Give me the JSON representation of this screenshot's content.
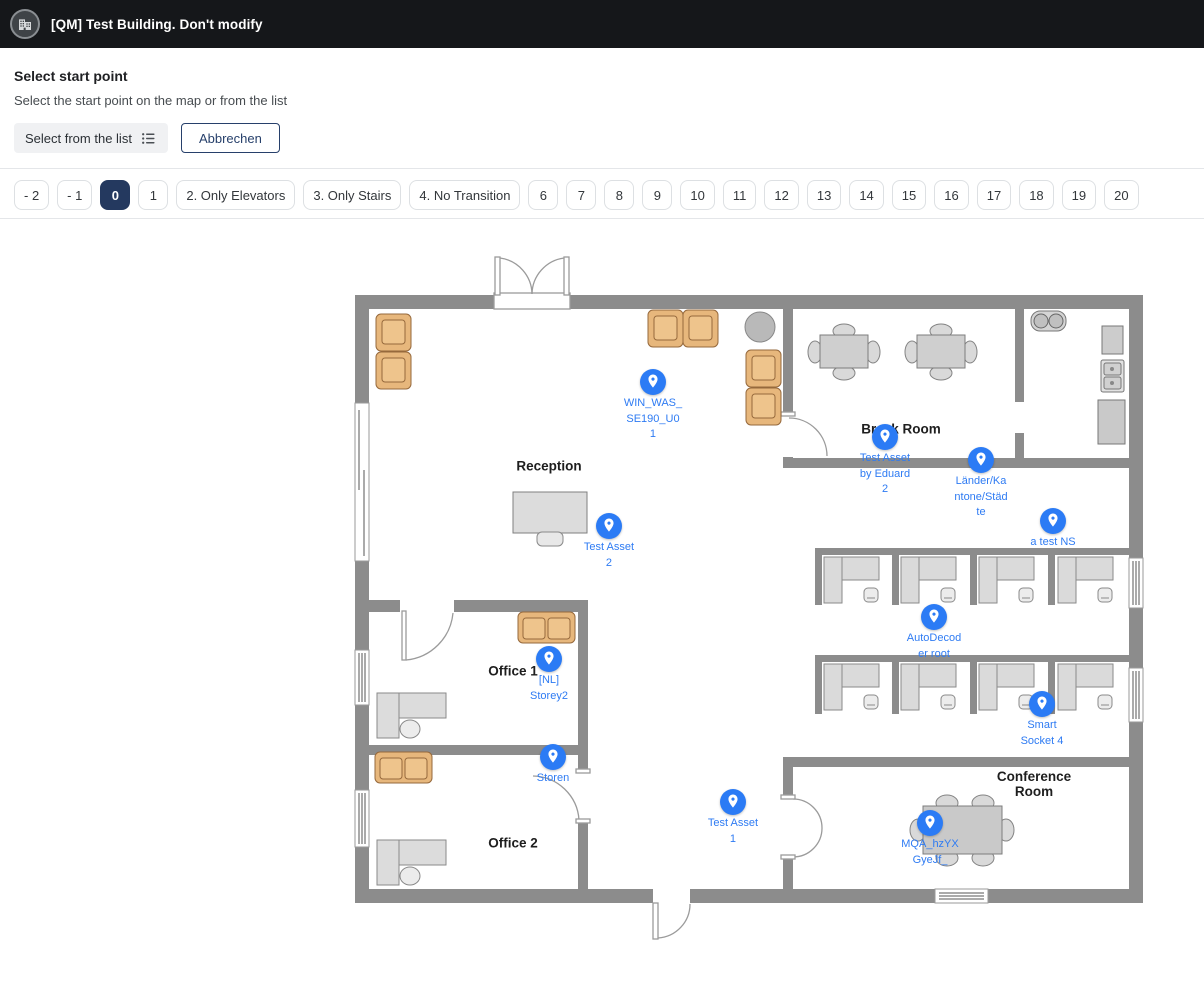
{
  "topbar": {
    "title": "[QM] Test Building. Don't modify",
    "icon": "building-icon"
  },
  "header": {
    "title": "Select start point",
    "subtitle": "Select the start point on the map or from the list"
  },
  "actions": {
    "select_from_list": "Select from the list",
    "cancel": "Abbrechen"
  },
  "floors": {
    "selected": "0",
    "items": [
      "- 2",
      "- 1",
      "0",
      "1",
      "2. Only Elevators",
      "3. Only Stairs",
      "4. No Transition",
      "6",
      "7",
      "8",
      "9",
      "10",
      "11",
      "12",
      "13",
      "14",
      "15",
      "16",
      "17",
      "18",
      "19",
      "20"
    ]
  },
  "map": {
    "colors": {
      "marker_blue": "#2b7bf5",
      "marker_text": "#2e7bf3",
      "wall_gray": "#8c8c8c",
      "furniture_tan": "#e7b77c",
      "furniture_gray": "#d6d6d6",
      "selected_chip": "#24395f"
    },
    "rooms": [
      {
        "name": "Reception",
        "x": 549,
        "y": 466
      },
      {
        "name": "Office 1",
        "x": 513,
        "y": 671
      },
      {
        "name": "Office 2",
        "x": 513,
        "y": 843
      },
      {
        "name": "Break Room",
        "x": 901,
        "y": 429
      },
      {
        "name": "Conference\nRoom",
        "x": 1034,
        "y": 784
      }
    ],
    "markers": [
      {
        "label": "WIN_WAS_\nSE190_U0\n1",
        "x": 653,
        "y": 382
      },
      {
        "label": "Test Asset\n2",
        "x": 609,
        "y": 526
      },
      {
        "label": "Test Asset\nby Eduard\n2",
        "x": 885,
        "y": 437
      },
      {
        "label": "Länder/Ka\nntone/Städ\nte",
        "x": 981,
        "y": 460
      },
      {
        "label": "a test NS",
        "x": 1053,
        "y": 521
      },
      {
        "label": "AutoDecod\ner root",
        "x": 934,
        "y": 617
      },
      {
        "label": "Smart\nSocket 4",
        "x": 1042,
        "y": 704
      },
      {
        "label": "[NL]\nStorey2",
        "x": 549,
        "y": 659
      },
      {
        "label": "Storen",
        "x": 553,
        "y": 757
      },
      {
        "label": "Test Asset\n1",
        "x": 733,
        "y": 802
      },
      {
        "label": "MQA_hzYX\nGyeJf_",
        "x": 930,
        "y": 823
      }
    ]
  }
}
